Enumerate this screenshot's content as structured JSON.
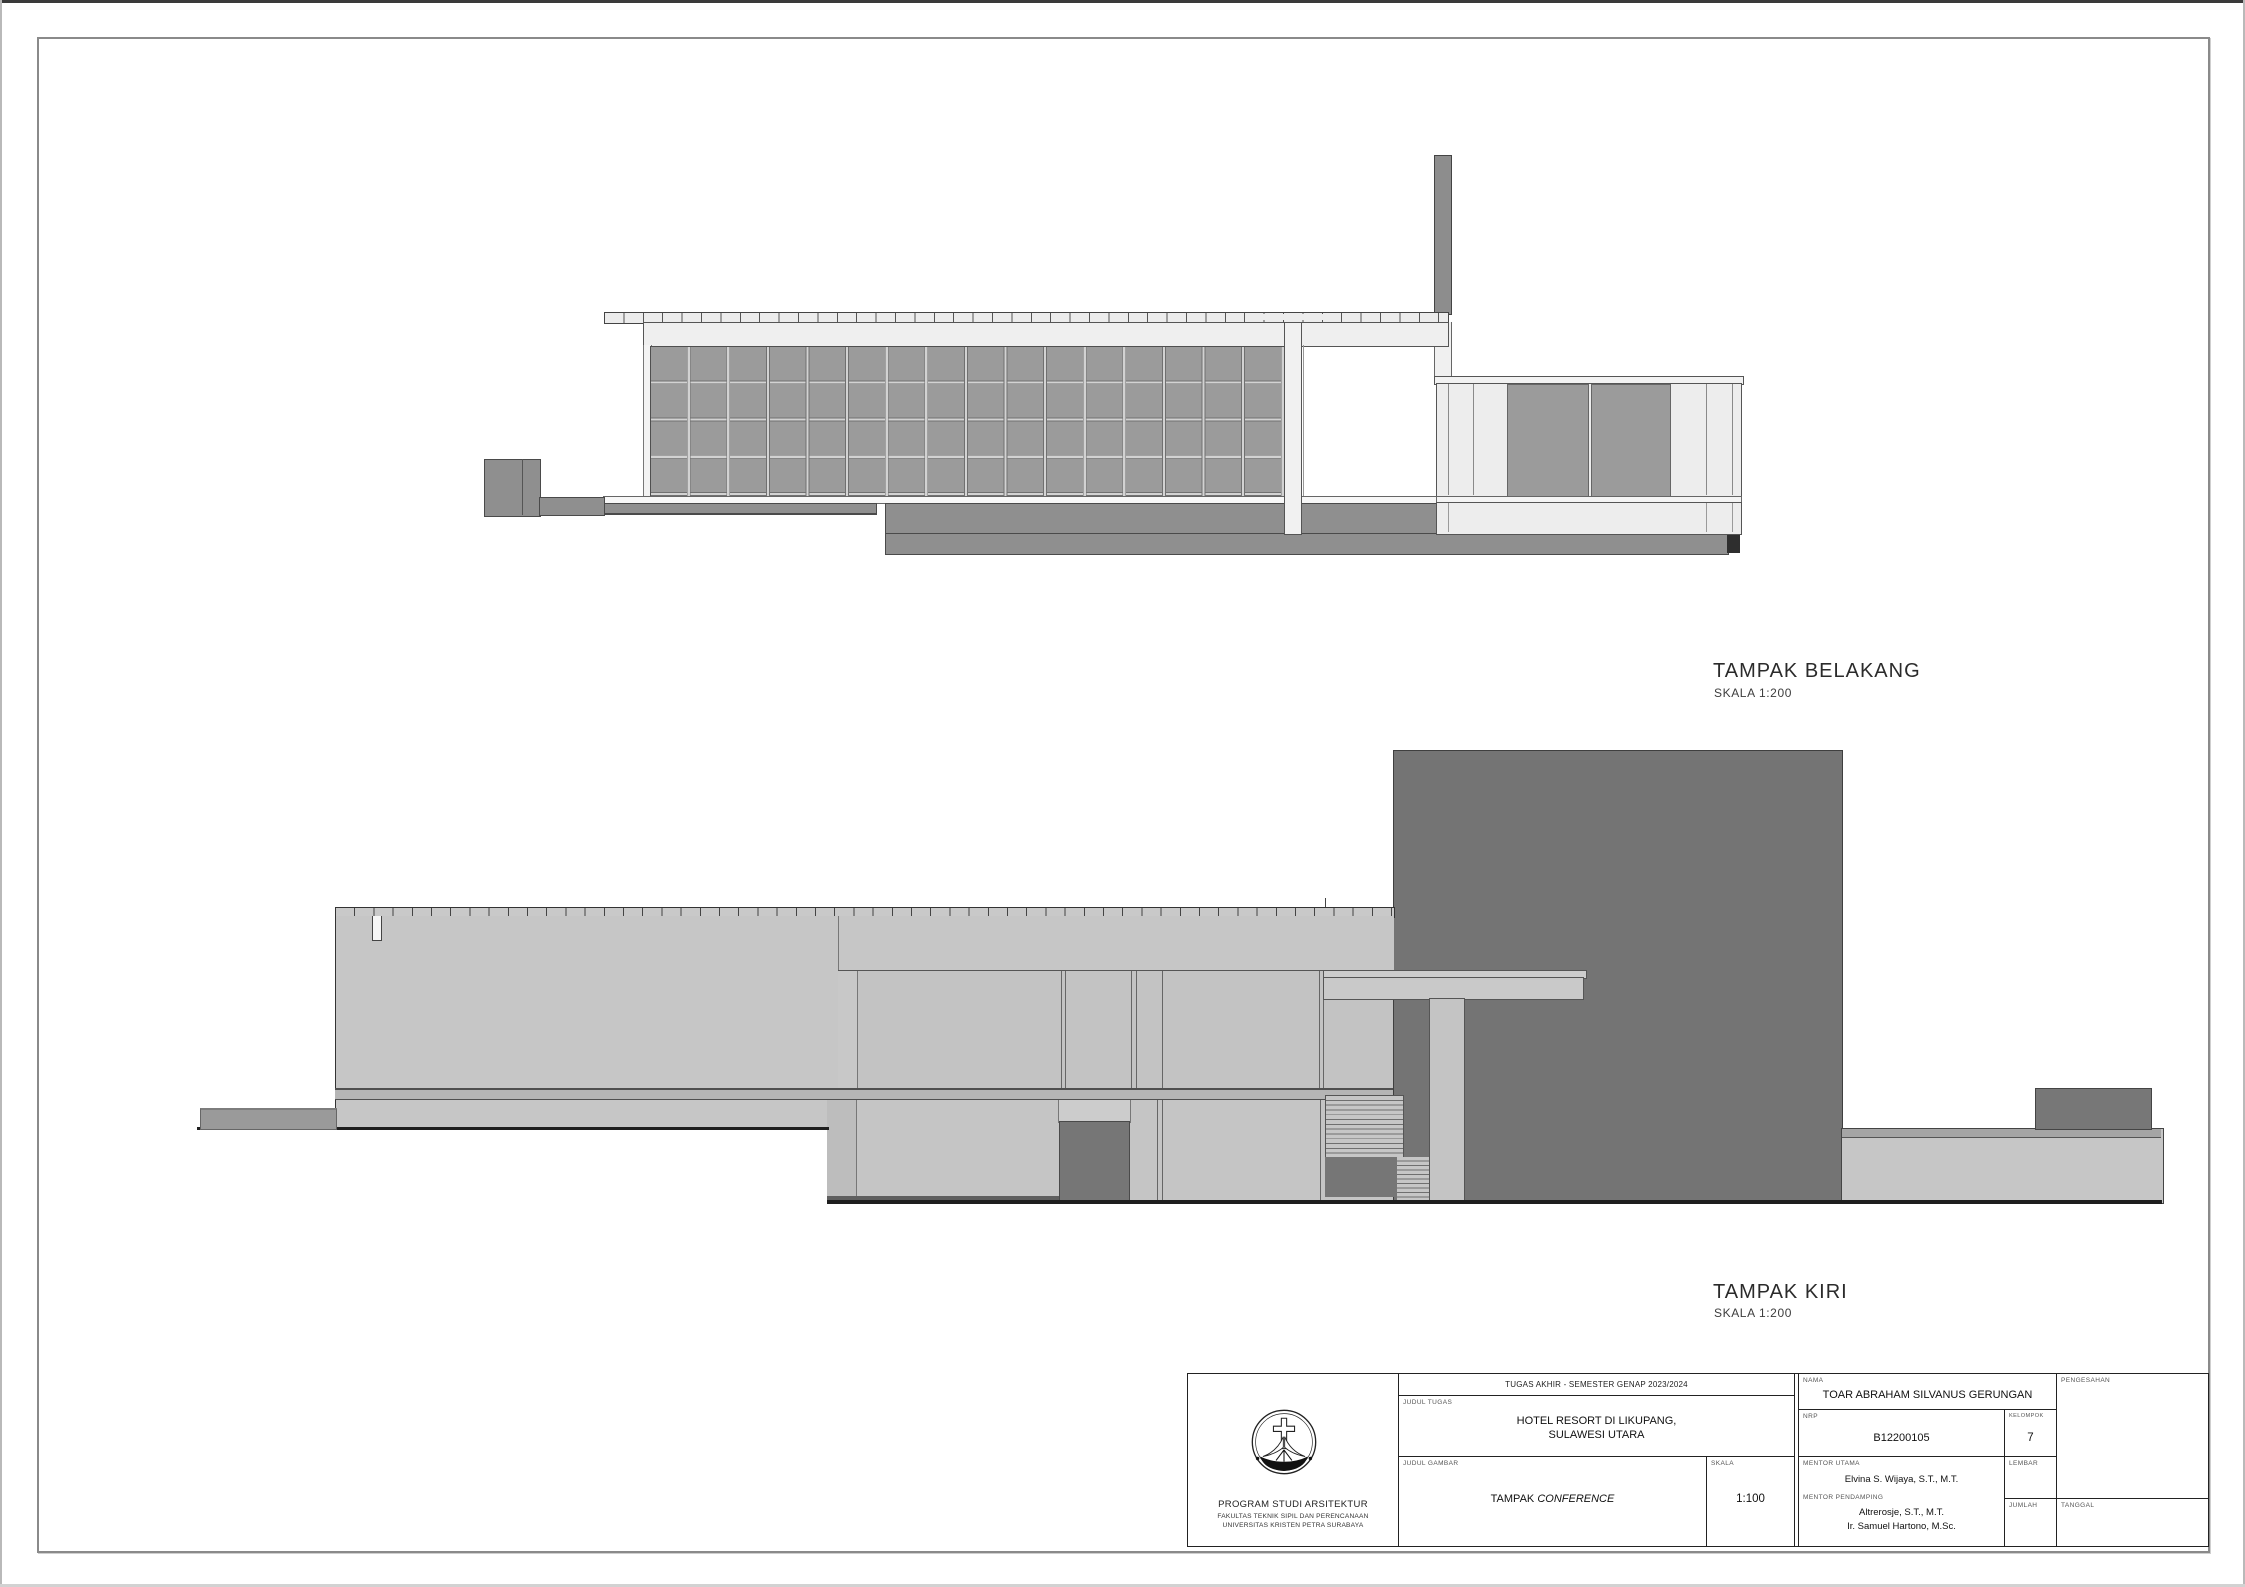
{
  "drawings": [
    {
      "id": "back-elevation",
      "title": "TAMPAK BELAKANG",
      "scale_label": "SKALA 1:200",
      "elements": [
        "chimney",
        "roof-slab-with-tiles",
        "fascia",
        "screen-block-facade-grid-16x4",
        "structural-pier",
        "glass-annex-with-two-gray-panels",
        "base-plinth",
        "service-block"
      ]
    },
    {
      "id": "left-elevation",
      "title": "TAMPAK KIRI",
      "scale_label": "SKALA 1:200",
      "elements": [
        "parapet-cap-with-coping-ticks",
        "roof-drain",
        "main-wall",
        "curtain-wall-story",
        "dark-tower-mass",
        "entry-canopy",
        "canopy-column",
        "stair-flights",
        "dark-doorway",
        "entry-ramp",
        "rear-platform",
        "rooftop-unit",
        "ground-line"
      ]
    }
  ],
  "title_block": {
    "header": "TUGAS AKHIR - SEMESTER GENAP 2023/2024",
    "judul_tugas_label": "JUDUL TUGAS",
    "judul_tugas_line1": "HOTEL RESORT DI LIKUPANG,",
    "judul_tugas_line2": "SULAWESI UTARA",
    "judul_gambar_label": "JUDUL GAMBAR",
    "judul_gambar_prefix": "TAMPAK ",
    "judul_gambar_name": "CONFERENCE",
    "skala_label": "SKALA",
    "skala_value": "1:100",
    "nama_label": "NAMA",
    "nama_value": "TOAR ABRAHAM SILVANUS GERUNGAN",
    "nrp_label": "NRP",
    "nrp_value": "B12200105",
    "kelompok_label": "KELOMPOK",
    "kelompok_value": "7",
    "mentor_utama_label": "MENTOR UTAMA",
    "mentor_utama_value": "Elvina S. Wijaya, S.T., M.T.",
    "mentor_pendamping_label": "MENTOR PENDAMPING",
    "mentor_pendamping_1": "Altrerosje, S.T., M.T.",
    "mentor_pendamping_2": "Ir. Samuel Hartono, M.Sc.",
    "pengesahan_label": "PENGESAHAN",
    "lembar_label": "LEMBAR",
    "jumlah_label": "JUMLAH",
    "tanggal_label": "TANGGAL",
    "institution_line1": "PROGRAM STUDI ARSITEKTUR",
    "institution_line2": "FAKULTAS TEKNIK SIPIL DAN PERENCANAAN",
    "institution_line3": "UNIVERSITAS KRISTEN PETRA SURABAYA",
    "logo": "petra-christian-university-emblem"
  },
  "colors": {
    "paper": "#ffffff",
    "sheet_border": "#8a8a8a",
    "light_panel": "#ededed",
    "screen_block": "#9b9b9b",
    "plinth_gray": "#8f8f8f",
    "wall_light": "#c6c6c6",
    "tower_dark": "#747474",
    "door_dark": "#767676",
    "end_cap_black": "#2e2e2e",
    "ground_line": "#1e1e1e",
    "line_dark": "#333333"
  }
}
